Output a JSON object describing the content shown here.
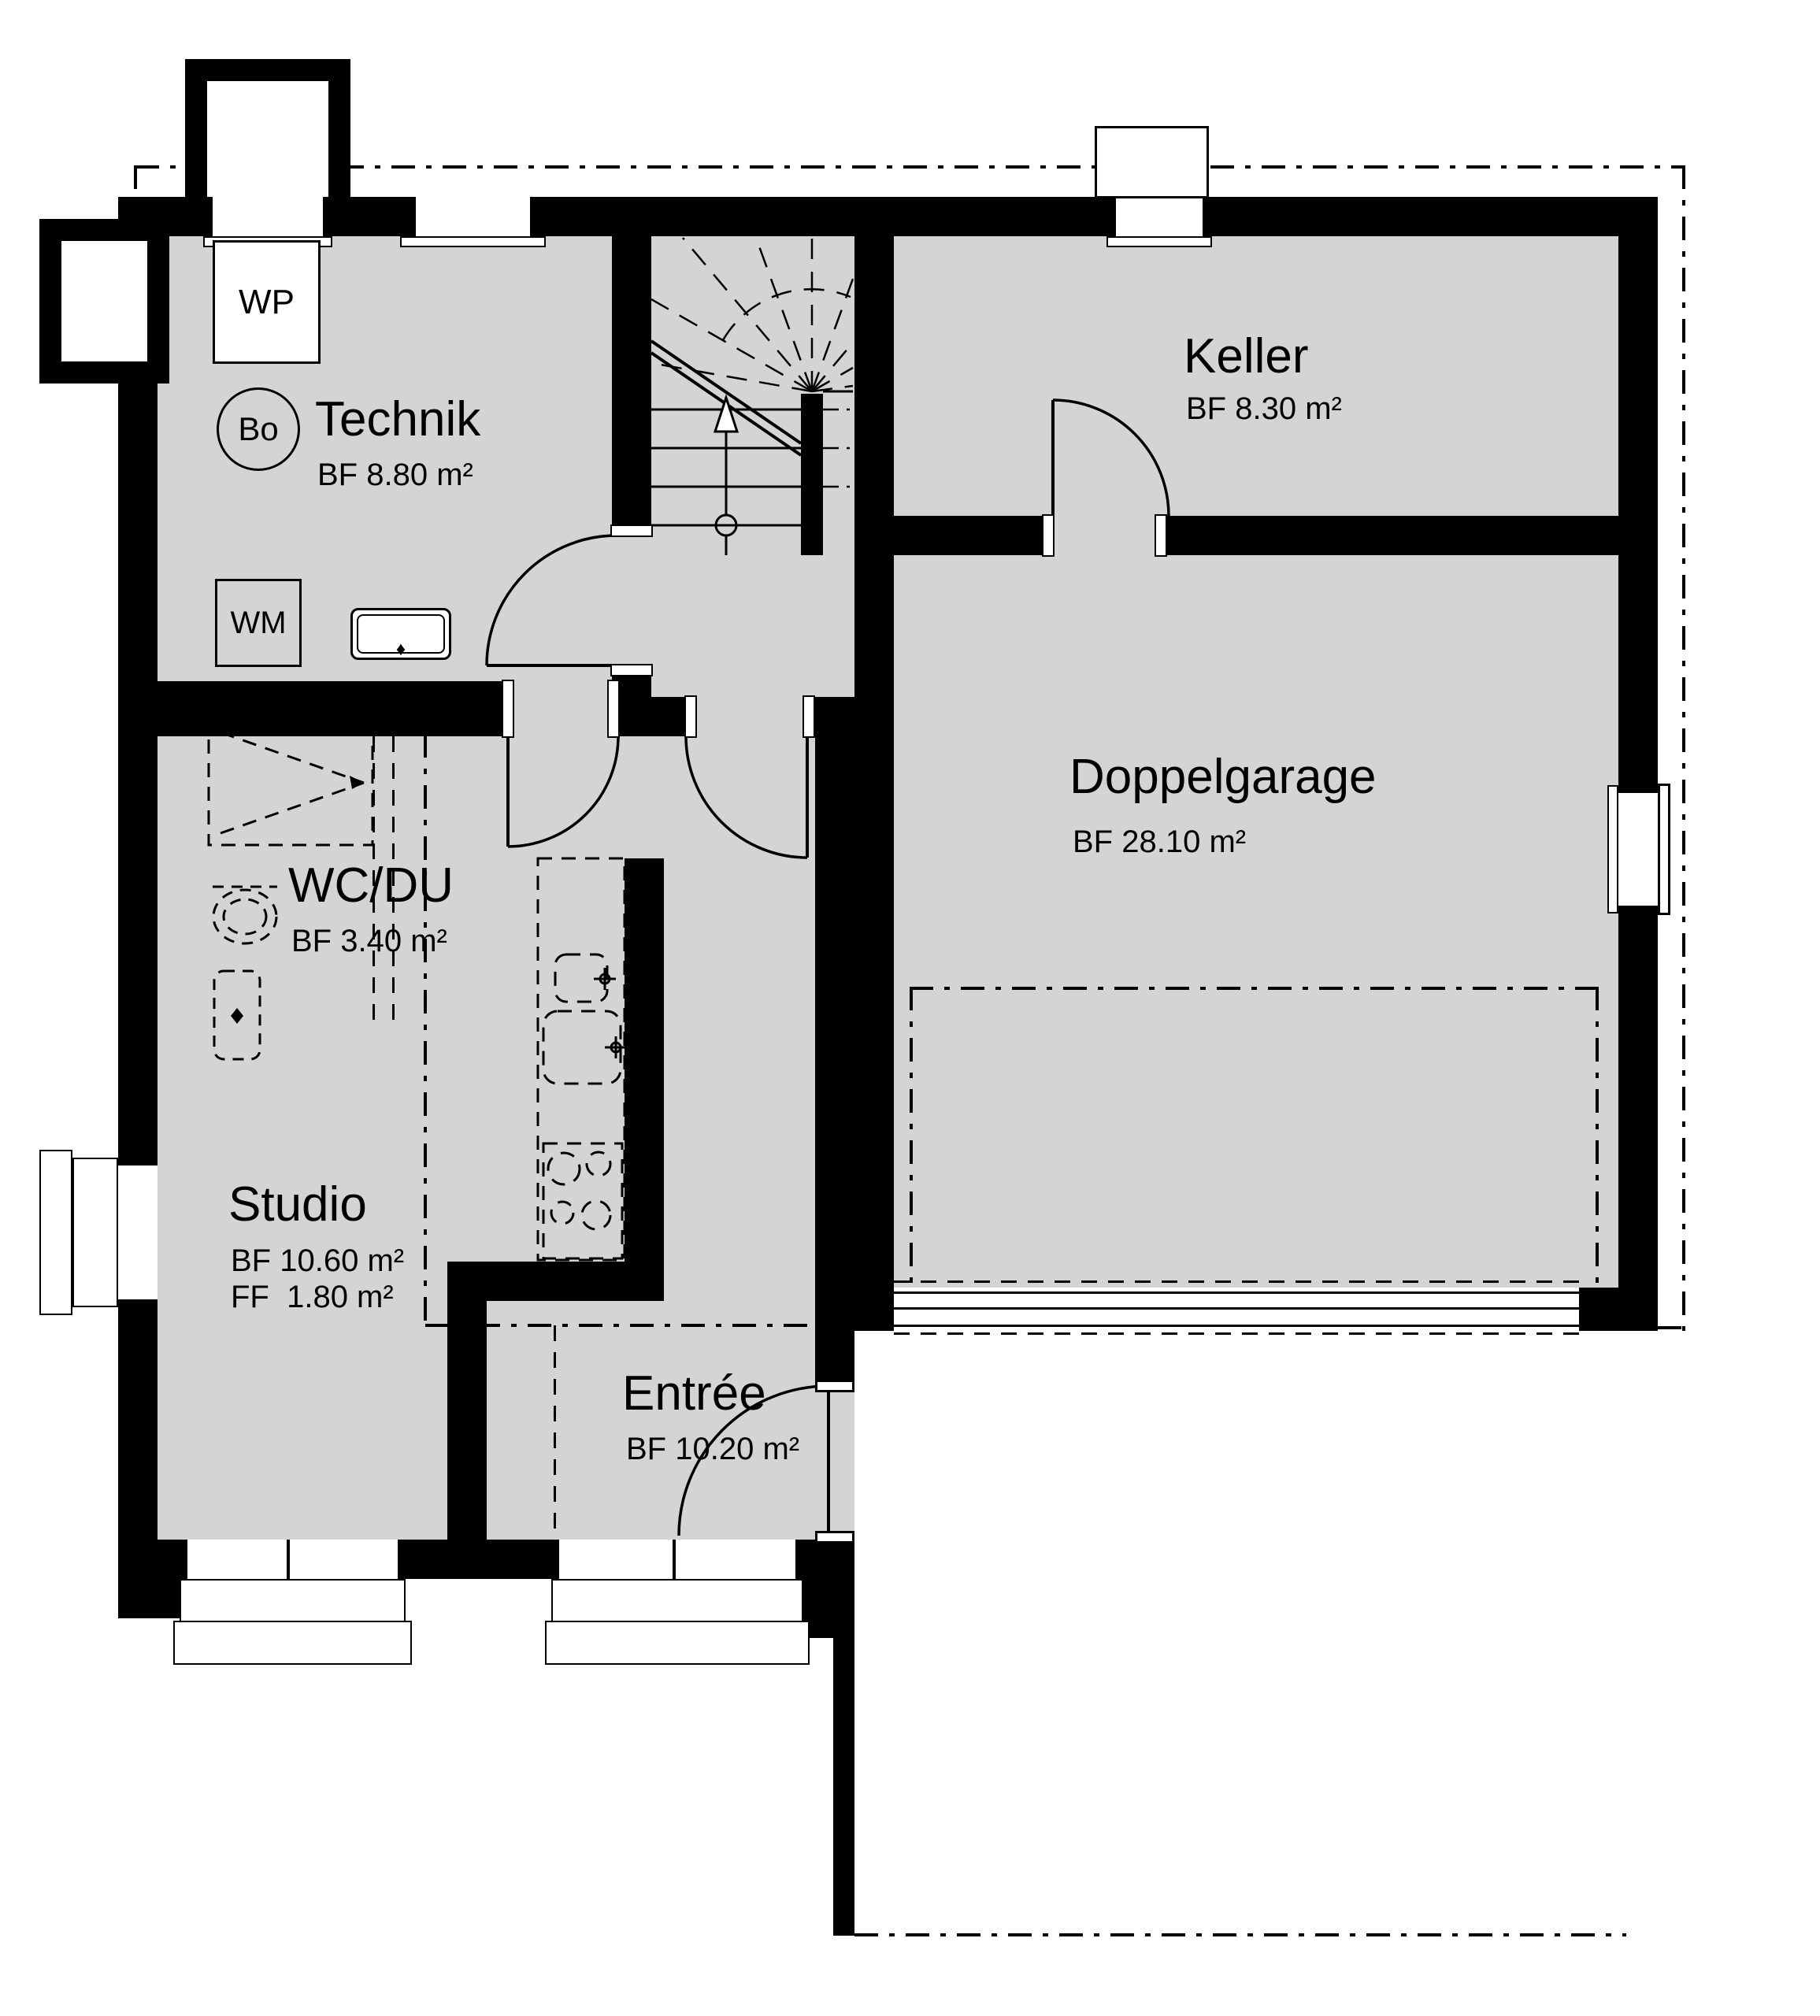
{
  "plan": {
    "type": "floorplan",
    "rooms": [
      {
        "name": "Technik",
        "area": "BF 8.80 m²"
      },
      {
        "name": "Keller",
        "area": "BF 8.30 m²"
      },
      {
        "name": "Doppelgarage",
        "area": "BF 28.10 m²"
      },
      {
        "name": "WC/DU",
        "area": "BF 3.40 m²"
      },
      {
        "name": "Studio",
        "area": "BF 10.60 m²",
        "area_ff": "FF  1.80 m²"
      },
      {
        "name": "Entrée",
        "area": "BF 10.20 m²"
      }
    ],
    "equipment": {
      "heat_pump": "WP",
      "boiler": "Bo",
      "washing_machine": "WM"
    },
    "colors": {
      "wall": "#000000",
      "floor": "#d4d4d4",
      "background": "#ffffff"
    }
  }
}
